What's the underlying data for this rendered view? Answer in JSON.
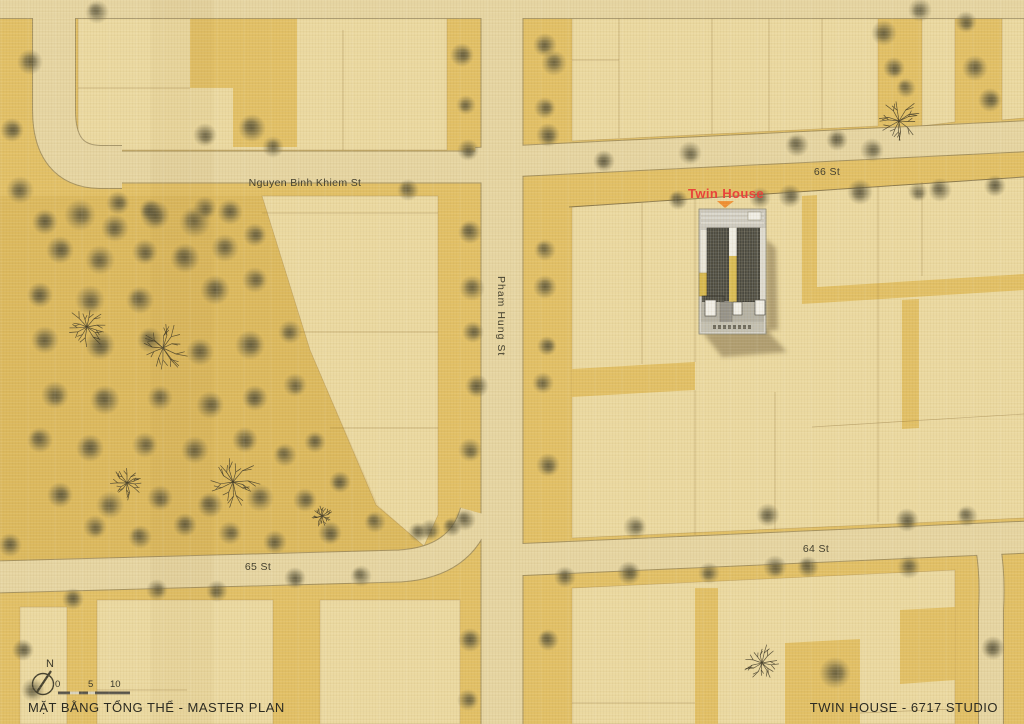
{
  "page": {
    "title": "Twin House - Master Plan"
  },
  "map": {
    "street_labels": [
      {
        "id": "nguyen-binh-khiem",
        "text": "Nguyen Binh Khiem St"
      },
      {
        "id": "66-st",
        "text": "66 St"
      },
      {
        "id": "pham-hung",
        "text": "Pham Hung St"
      },
      {
        "id": "65-st",
        "text": "65 St"
      },
      {
        "id": "64-st",
        "text": "64 St"
      }
    ],
    "site_label": {
      "text": "Twin House"
    },
    "north_label": "N",
    "scale_bar": {
      "ticks": [
        "0",
        "5",
        "10"
      ]
    }
  },
  "footer": {
    "left_caption": "MẶT BẰNG TỔNG THỂ - MASTER PLAN",
    "right_caption": "TWIN HOUSE - 6717 STUDIO"
  },
  "colors": {
    "ground": "#e2c066",
    "lot": "#ebd9a1",
    "road": "#e6d5a2",
    "curb": "#97875f",
    "tree": "#5b5640",
    "site_accent": "#e8443b",
    "marker_orange": "#ef8f33",
    "ink": "#2c2b22",
    "building_dark": "#4a493f",
    "building_light": "#d6d3c9",
    "building_yellow": "#d9bc55"
  }
}
